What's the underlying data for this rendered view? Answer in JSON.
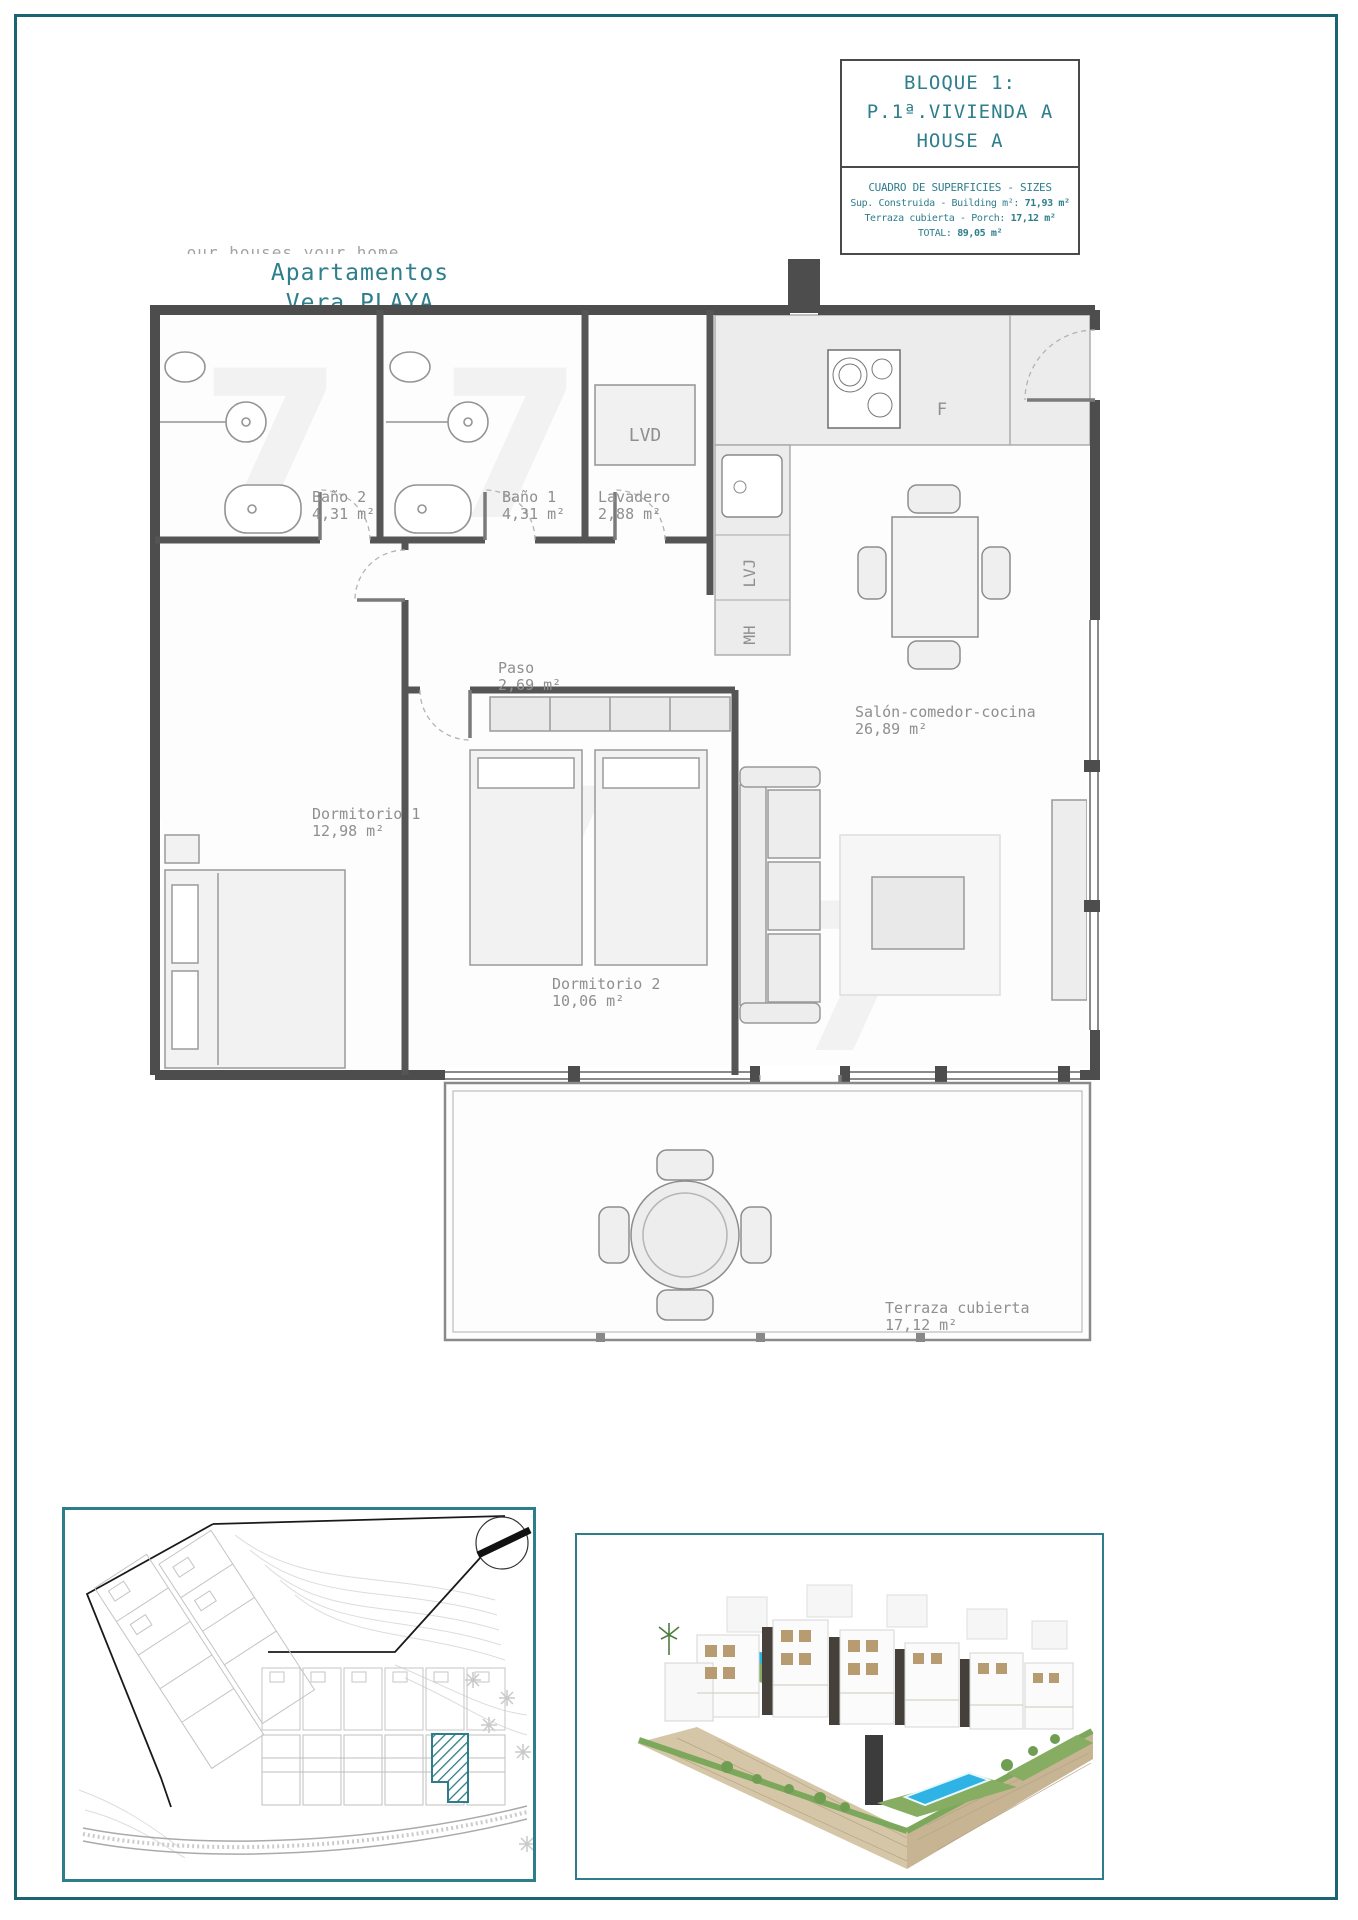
{
  "colors": {
    "accent_teal": "#2e7e8c",
    "page_border": "#1a6473",
    "box_border": "#2e7d8a",
    "wall_gray": "#4d4d4d",
    "label_gray": "#8f8f8f",
    "pool_blue": "#2eb3e4"
  },
  "branding": {
    "tagline": "our houses your home",
    "title_lines": [
      "Apartamentos",
      "Vera PLAYA",
      "(ALMERÍA)"
    ]
  },
  "title_block": {
    "lines": [
      "BLOQUE 1:",
      "P.1ª.VIVIENDA A",
      "HOUSE A"
    ]
  },
  "sizes_table": {
    "header": "CUADRO DE SUPERFICIES - SIZES",
    "rows": [
      {
        "label": "Sup. Construida - Building m²:",
        "value": "71,93 m²"
      },
      {
        "label": "Terraza cubierta - Porch:",
        "value": "17,12 m²"
      },
      {
        "label": "TOTAL:",
        "value": "89,05 m²"
      }
    ]
  },
  "floor_plan": {
    "rooms": [
      {
        "name": "Baño 2",
        "area": "4,31 m²"
      },
      {
        "name": "Baño 1",
        "area": "4,31 m²"
      },
      {
        "name": "Lavadero",
        "area": "2,88 m²"
      },
      {
        "name": "Paso",
        "area": "2,69 m²"
      },
      {
        "name": "Dormitorio 1",
        "area": "12,98 m²"
      },
      {
        "name": "Dormitorio 2",
        "area": "10,06 m²"
      },
      {
        "name": "Salón-comedor-cocina",
        "area": "26,89 m²"
      },
      {
        "name": "Terraza cubierta",
        "area": "17,12 m²"
      }
    ],
    "appliances": {
      "washer_dryer": "LVD",
      "dishwasher": "LVJ",
      "micro_oven": "MH",
      "fridge": "F"
    }
  }
}
